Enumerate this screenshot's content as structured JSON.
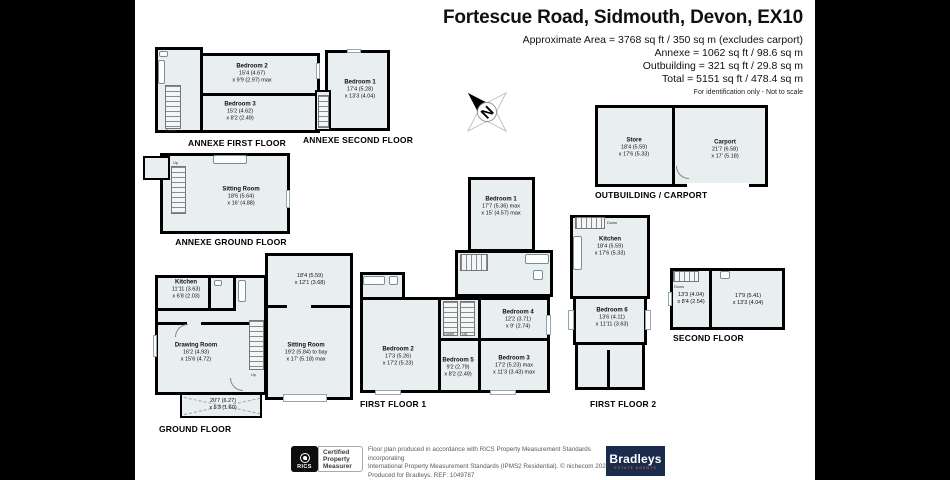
{
  "header": {
    "title": "Fortescue Road, Sidmouth, Devon, EX10",
    "lines": [
      "Approximate Area = 3768 sq ft / 350 sq m (excludes carport)",
      "Annexe = 1062 sq ft / 98.6 sq m",
      "Outbuilding = 321 sq ft / 29.8 sq m",
      "Total = 5151 sq ft / 478.4 sq m"
    ],
    "note": "For identification only - Not to scale"
  },
  "compass": {
    "letter": "N"
  },
  "stair": {
    "up": "Up",
    "down": "Down"
  },
  "plans": {
    "annexe_first": {
      "label": "ANNEXE FIRST FLOOR",
      "rooms": {
        "bedroom2": {
          "name": "Bedroom 2",
          "dims": [
            "15'4 (4.67)",
            "x 9'9 (2.97) max"
          ]
        },
        "bedroom3": {
          "name": "Bedroom 3",
          "dims": [
            "15'2 (4.62)",
            "x 8'2 (2.49)"
          ]
        }
      }
    },
    "annexe_second": {
      "label": "ANNEXE SECOND FLOOR",
      "rooms": {
        "bedroom1": {
          "name": "Bedroom 1",
          "dims": [
            "17'4 (5.28)",
            "x 13'3 (4.04)"
          ]
        }
      }
    },
    "annexe_ground": {
      "label": "ANNEXE GROUND FLOOR",
      "rooms": {
        "sitting": {
          "name": "Sitting Room",
          "dims": [
            "18'6 (5.64)",
            "x 16' (4.88)"
          ]
        }
      }
    },
    "outbuilding": {
      "label": "OUTBUILDING / CARPORT",
      "rooms": {
        "store": {
          "name": "Store",
          "dims": [
            "18'4 (5.59)",
            "x 17'6 (5.33)"
          ]
        },
        "carport": {
          "name": "Carport",
          "dims": [
            "21'7 (6.58)",
            "x 17' (5.18)"
          ]
        }
      }
    },
    "ground": {
      "label": "GROUND FLOOR",
      "rooms": {
        "kitchen": {
          "name": "Kitchen",
          "dims": [
            "11'11 (3.63)",
            "x 6'8 (2.03)"
          ]
        },
        "drawing": {
          "name": "Drawing Room",
          "dims": [
            "16'2 (4.93)",
            "x 15'6 (4.72)"
          ]
        },
        "sitting": {
          "name": "Sitting Room",
          "dims": [
            "19'2 (5.84) to bay",
            "x 17' (5.18) max"
          ]
        },
        "upper": {
          "dims": [
            "18'4 (5.59)",
            "x 12'1 (3.68)"
          ]
        },
        "porch": {
          "dims": [
            "20'7 (6.27)",
            "x 5'3 (1.60)"
          ]
        }
      }
    },
    "first1": {
      "label": "FIRST FLOOR 1",
      "rooms": {
        "bedroom1": {
          "name": "Bedroom 1",
          "dims": [
            "17'7 (5.36) max",
            "x 15' (4.57) max"
          ]
        },
        "bedroom2": {
          "name": "Bedroom 2",
          "dims": [
            "17'3 (5.26)",
            "x 17'2 (5.23)"
          ]
        },
        "bedroom3": {
          "name": "Bedroom 3",
          "dims": [
            "17'2 (5.23) max",
            "x 11'3 (3.43) max"
          ]
        },
        "bedroom4": {
          "name": "Bedroom 4",
          "dims": [
            "12'2 (3.71)",
            "x 9' (2.74)"
          ]
        },
        "bedroom5": {
          "name": "Bedroom 5",
          "dims": [
            "9'2 (2.79)",
            "x 8'2 (2.49)"
          ]
        }
      }
    },
    "first2": {
      "label": "FIRST FLOOR 2",
      "rooms": {
        "kitchen": {
          "name": "Kitchen",
          "dims": [
            "18'4 (5.59)",
            "x 17'6 (5.33)"
          ]
        },
        "bedroom6": {
          "name": "Bedroom 6",
          "dims": [
            "13'6 (4.11)",
            "x 11'11 (3.63)"
          ]
        }
      }
    },
    "second": {
      "label": "SECOND FLOOR",
      "rooms": {
        "left": {
          "dims": [
            "13'3 (4.04)",
            "x 8'4 (2.54)"
          ]
        },
        "right": {
          "dims": [
            "17'9 (5.41)",
            "x 13'3 (4.04)"
          ]
        }
      }
    }
  },
  "footer": {
    "rics": "RICS",
    "certified": [
      "Certified",
      "Property",
      "Measurer"
    ],
    "disclaimer": [
      "Floor plan produced in accordance with RICS Property Measurement Standards incorporating",
      "International Property Measurement Standards (IPMS2 Residential).   © nichecom 2024.",
      "Produced for Bradleys.   REF: 1049787"
    ],
    "brand": "Bradleys",
    "brand_tagline": "ESTATE AGENTS"
  },
  "colors": {
    "wall": "#000000",
    "floor": "#e9eef1",
    "page": "#ffffff",
    "brand_navy": "#1b2b4c",
    "brand_orange": "#e07b39"
  }
}
